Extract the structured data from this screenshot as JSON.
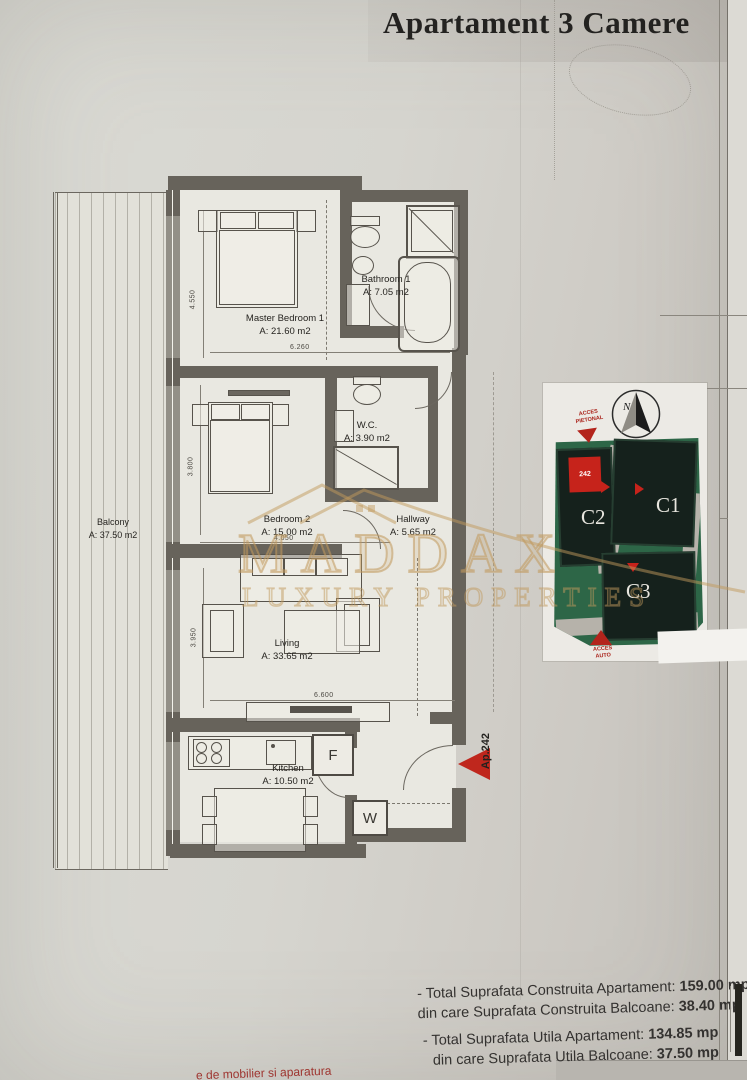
{
  "title": "Apartament 3 Camere",
  "rooms": {
    "master": {
      "name": "Master Bedroom 1",
      "area": "A: 21.60 m2"
    },
    "bathroom": {
      "name": "Bathroom 1",
      "area": "A: 7.05 m2"
    },
    "bedroom2": {
      "name": "Bedroom 2",
      "area": "A: 15.00 m2"
    },
    "wc": {
      "name": "W.C.",
      "area": "A: 3.90 m2"
    },
    "hallway": {
      "name": "Hallway",
      "area": "A: 5.65 m2"
    },
    "living": {
      "name": "Living",
      "area": "A: 33.65 m2"
    },
    "kitchen": {
      "name": "Kitchen",
      "area": "A: 10.50 m2"
    },
    "balcony": {
      "name": "Balcony",
      "area": "A: 37.50 m2"
    }
  },
  "dimensions": {
    "master_height": "4.550",
    "master_width": "6.260",
    "bedroom2_height": "3.800",
    "bedroom2_width": "4.050",
    "living_height": "3.950",
    "living_width": "6.600"
  },
  "appliances": {
    "fridge": "F",
    "washer": "W"
  },
  "apartment_marker": "Ap.242",
  "site_plan": {
    "compass": "N",
    "access_top": "ACCES PIETONAL",
    "access_bottom": "ACCES AUTO",
    "buildings": [
      "C1",
      "C2",
      "C3"
    ],
    "unit_marker": "242"
  },
  "watermark": {
    "brand": "MADDAX",
    "tagline": "LUXURY PROPERTIES"
  },
  "totals": [
    {
      "label": "- Total Suprafata Construita Apartament: ",
      "value": "159.00 mp"
    },
    {
      "label": "din care Suprafata Construita Balcoane: ",
      "value": "38.40 mp"
    },
    {
      "label": "- Total Suprafata Utila Apartament: ",
      "value": "134.85 mp"
    },
    {
      "label": "din care Suprafata Utila Balcoane: ",
      "value": "37.50 mp"
    }
  ],
  "footnote_fragment": "e de mobilier si aparatura",
  "colors": {
    "accent_red": "#bf271d",
    "site_green": "#2d6647",
    "building_dark": "#15211c",
    "watermark_gold": "#c6a062",
    "wall": "#67635b",
    "paper": "#d7d6d0"
  }
}
